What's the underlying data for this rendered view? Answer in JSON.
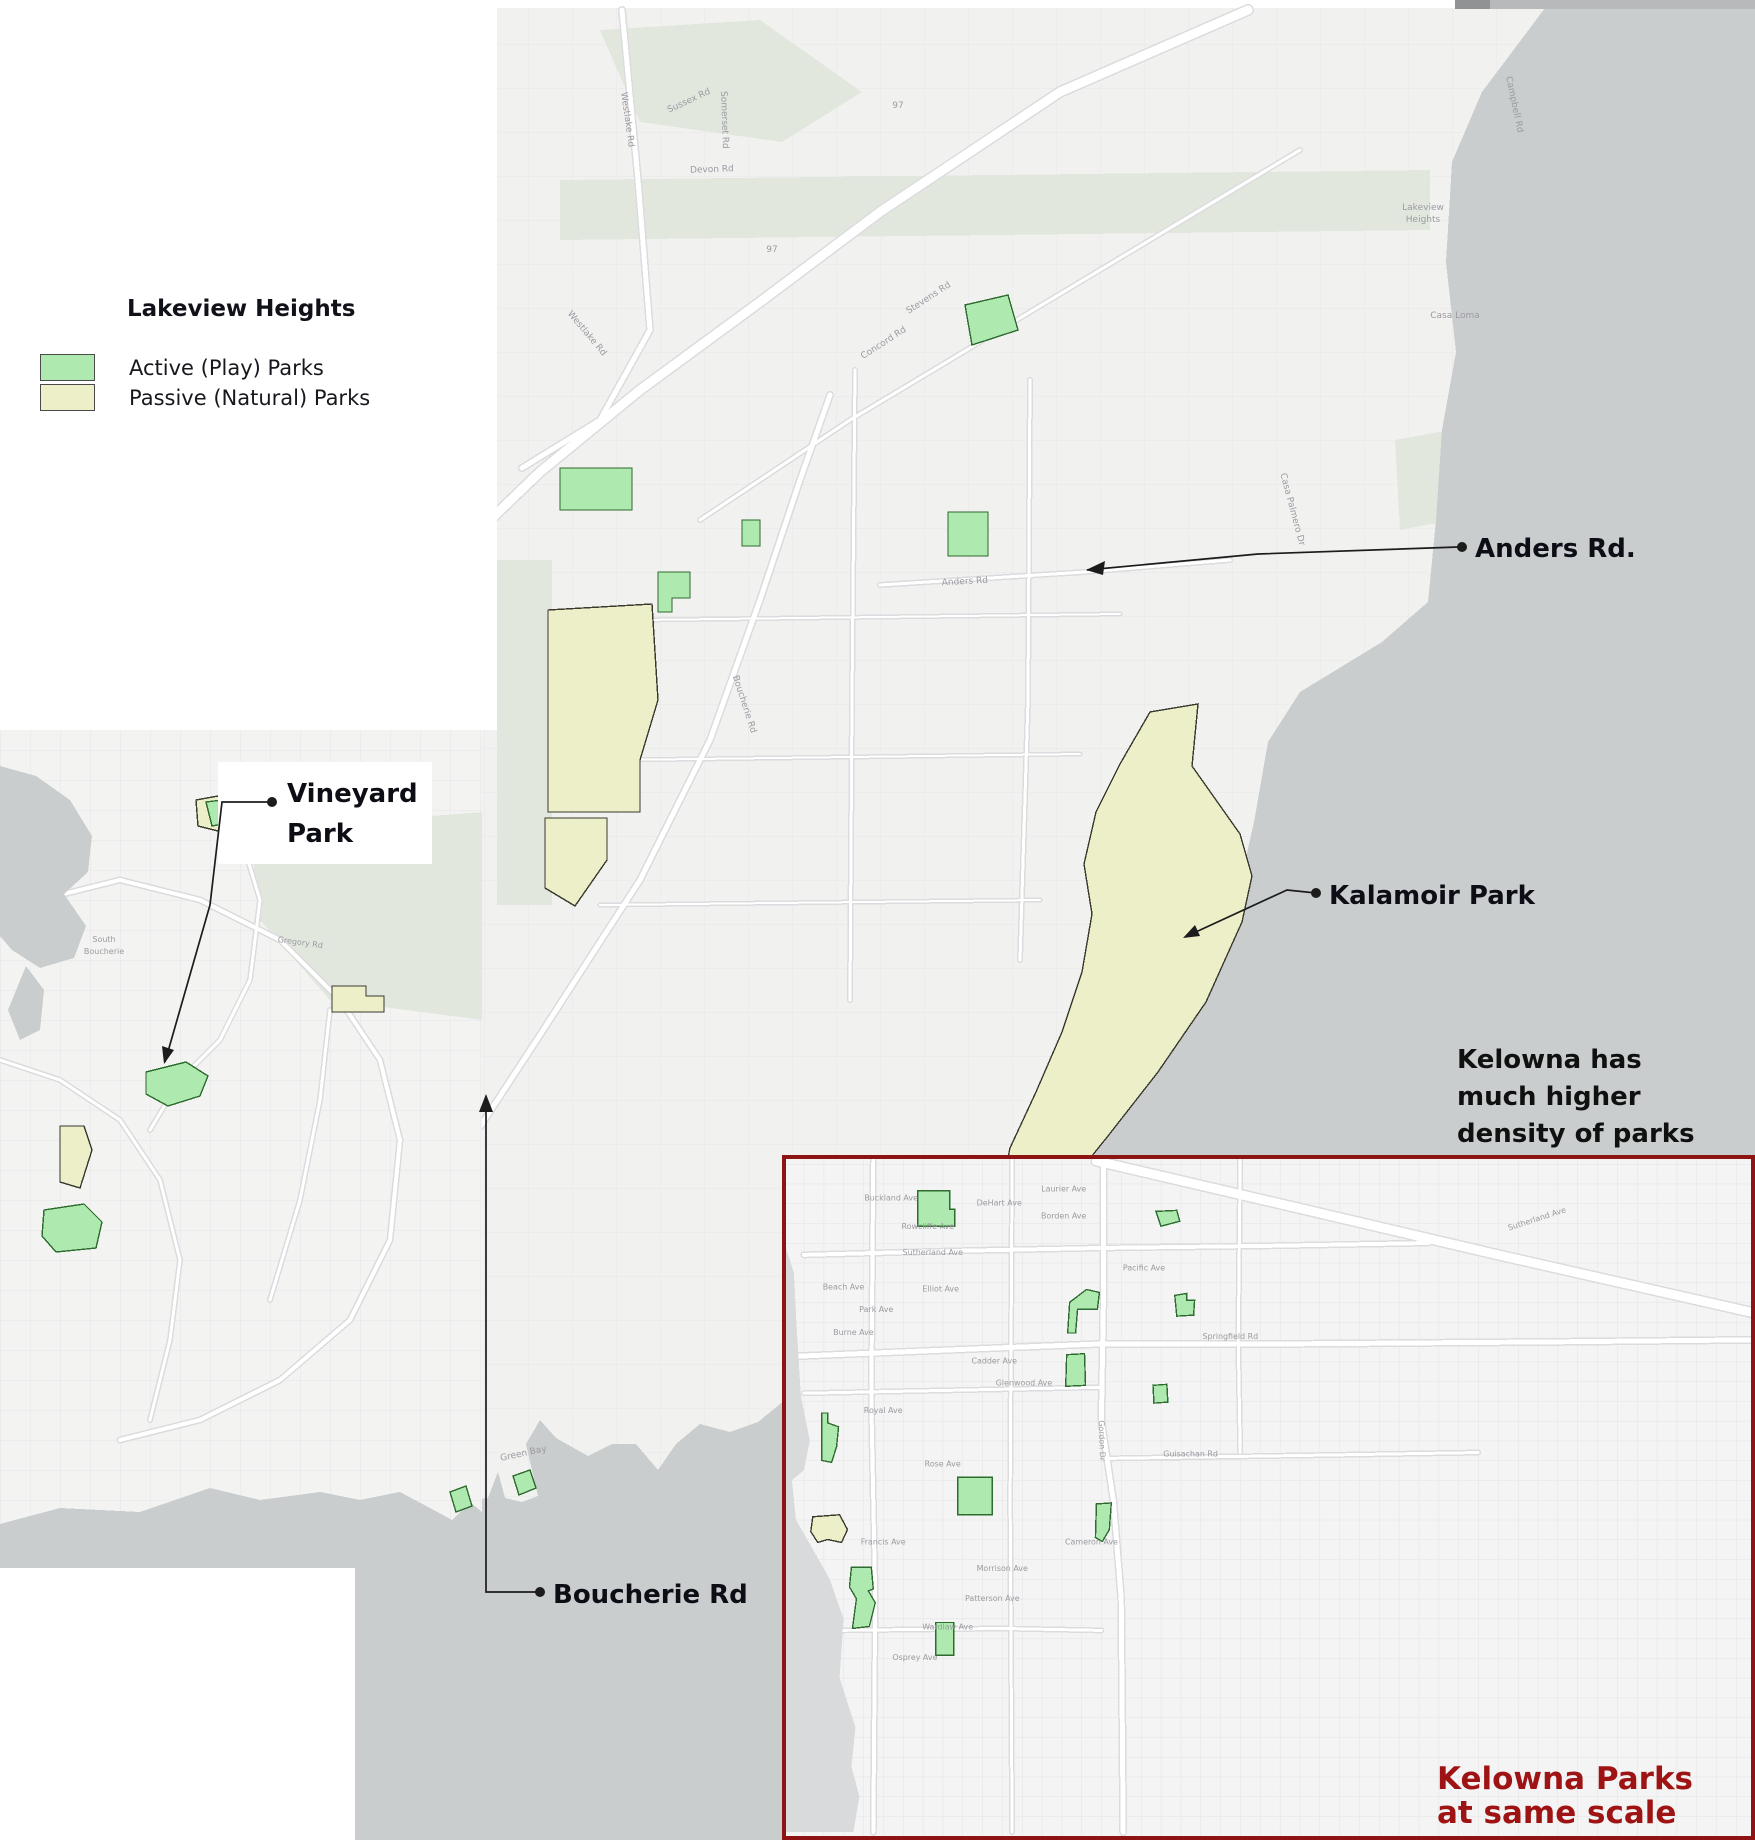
{
  "title": "Lakeview Heights parks map",
  "colors": {
    "active_park": "#aeeab0",
    "passive_park": "#edefc9",
    "active_stroke": "#2e6b2e",
    "passive_stroke": "#3a3a2e",
    "water": "#c9cdce",
    "water_kelowna": "#d8dadb",
    "sage": "#e2e7de",
    "road_casing": "#dcdcdf",
    "map_text": "#9b9ba1",
    "leader": "#1c1c1c",
    "inset_border": "#8e1414",
    "caption_red": "#9e1313",
    "label_black": "#0d0d16"
  },
  "legend": {
    "title": "Lakeview Heights",
    "items": [
      {
        "label": "Active (Play) Parks",
        "type": "active"
      },
      {
        "label": "Passive (Natural) Parks",
        "type": "passive"
      }
    ]
  },
  "annotations": {
    "anders": {
      "text": "Anders Rd."
    },
    "kalamoir": {
      "text": "Kalamoir Park"
    },
    "vineyard": {
      "lines": [
        "Vineyard",
        "Park"
      ]
    },
    "boucherie": {
      "text": "Boucherie Rd"
    },
    "density_note": {
      "lines": [
        "Kelowna has",
        "much higher",
        "density of parks"
      ]
    },
    "kelowna_caption": {
      "lines": [
        "Kelowna Parks",
        "at same scale"
      ]
    }
  },
  "geo": {
    "main": {
      "land": "355,8 1755,8 1755,1840 355,1840",
      "sage": [
        "560,180 1430,170 1430,230 560,240",
        "600,30 760,20 862,92 782,142 640,122",
        "497,560 552,560 552,905 497,905",
        "1395,440 1450,430 1452,520 1400,530"
      ],
      "roads": [
        {
          "p": "1248,10 1060,92 880,212 760,302 640,390 540,472 488,522",
          "w": 9
        },
        {
          "p": "622,10 638,180 650,330 600,420 522,468",
          "w": 5
        },
        {
          "p": "455,1165 540,1035 640,880 710,740 760,600 800,480 830,395",
          "w": 5
        },
        {
          "p": "700,520 850,420 1000,330 1150,240 1300,150",
          "w": 3
        },
        {
          "p": "1560,12 1520,120 1500,220 1490,330 1478,430 1470,540",
          "w": 4
        },
        {
          "p": "855,370 852,700 850,1000",
          "w": 3
        },
        {
          "p": "1030,380 1028,700 1020,960",
          "w": 3
        },
        {
          "p": "640,620 1120,614",
          "w": 2
        },
        {
          "p": "620,760 1080,754",
          "w": 2
        },
        {
          "p": "600,905 1040,900",
          "w": 2
        },
        {
          "p": "880,585 1085,572 1230,560",
          "w": 3
        }
      ],
      "water": [
        "1545,8 1755,8 1755,1840 355,1840 355,1552 372,1540 396,1524 424,1528 450,1520 468,1500 488,1498 498,1472 505,1498 522,1502 538,1496 532,1470 526,1444 540,1420 556,1438 588,1456 612,1444 636,1444 658,1470 676,1444 700,1424 730,1432 758,1422 790,1396 838,1354 900,1308 986,1248 1060,1182 1130,1092 1192,990 1240,884 1254,822 1268,742 1300,692 1382,642 1428,602 1436,520 1442,430 1456,352 1446,262 1452,162 1482,92"
      ],
      "parks": [
        {
          "name": "park-top-green",
          "type": "active",
          "pts": "965,305 1008,295 1018,330 972,345"
        },
        {
          "name": "park-green-rect",
          "type": "active",
          "pts": "560,468 632,468 632,510 560,510"
        },
        {
          "name": "park-tiny-green",
          "type": "active",
          "pts": "742,520 760,520 760,546 742,546"
        },
        {
          "name": "park-anders-green",
          "type": "active",
          "pts": "948,512 988,512 988,556 948,556"
        },
        {
          "name": "park-small-L",
          "type": "active",
          "pts": "658,572 690,572 690,598 672,598 672,612 658,612"
        },
        {
          "name": "park-large-passive",
          "type": "passive",
          "pts": "548,610 652,604 658,700 640,760 640,812 548,812"
        },
        {
          "name": "park-passive-south",
          "type": "passive",
          "pts": "545,818 607,818 607,860 575,906 545,888"
        },
        {
          "name": "kalamoir-park",
          "type": "passive",
          "pts": "1150,712 1198,704 1192,766 1240,834 1252,876 1242,922 1206,1002 1158,1072 1108,1136 1066,1188 1034,1218 1002,1186 1010,1148 1036,1092 1062,1032 1082,972 1092,914 1084,864 1096,812 1120,764"
        },
        {
          "name": "park-greenbay",
          "type": "active",
          "pts": "513,1476 530,1470 536,1488 519,1495"
        }
      ],
      "labels": [
        {
          "t": "Westlake Rd",
          "x": 625,
          "y": 120,
          "r": 82
        },
        {
          "t": "Westlake Rd",
          "x": 585,
          "y": 335,
          "r": 50
        },
        {
          "t": "Stevens Rd",
          "x": 930,
          "y": 300,
          "r": -33
        },
        {
          "t": "Concord Rd",
          "x": 885,
          "y": 345,
          "r": -33
        },
        {
          "t": "Somerset Rd",
          "x": 722,
          "y": 120,
          "r": 88
        },
        {
          "t": "Devon Rd",
          "x": 712,
          "y": 172,
          "r": -2
        },
        {
          "t": "Sussex Rd",
          "x": 690,
          "y": 103,
          "r": -25
        },
        {
          "t": "Boucherie Rd",
          "x": 742,
          "y": 705,
          "r": 72
        },
        {
          "t": "Campbell Rd",
          "x": 1512,
          "y": 105,
          "r": 78
        },
        {
          "t": "Casa Palmero Dr",
          "x": 1290,
          "y": 510,
          "r": 75
        },
        {
          "t": "Anders Rd",
          "x": 965,
          "y": 584,
          "r": -3
        },
        {
          "t": "Lakeview",
          "x": 1423,
          "y": 210,
          "r": 0
        },
        {
          "t": "Heights",
          "x": 1423,
          "y": 222,
          "r": 0
        },
        {
          "t": "Casa Loma",
          "x": 1455,
          "y": 318,
          "r": 0
        },
        {
          "t": "Green Bay",
          "x": 524,
          "y": 1456,
          "r": -12
        },
        {
          "t": "97",
          "x": 898,
          "y": 108,
          "r": 0
        },
        {
          "t": "97",
          "x": 772,
          "y": 252,
          "r": 0
        }
      ]
    },
    "left_inset": {
      "land": "0,728 482,728 482,1568 0,1568",
      "sage": [
        "250,830 482,812 482,1020 330,1000 260,920"
      ],
      "roads": [
        {
          "p": "40,900 120,880 200,900 280,940 340,1000 380,1060 400,1140 390,1240 350,1320 280,1380 200,1420 120,1440",
          "w": 4
        },
        {
          "p": "240,834 260,900 250,980 220,1040 180,1080 150,1130",
          "w": 3
        },
        {
          "p": "0,1060 60,1080 120,1120 160,1180 180,1260 170,1340 150,1420",
          "w": 3
        },
        {
          "p": "330,1010 320,1100 300,1200 270,1300",
          "w": 3
        }
      ],
      "water": [
        "0,766 36,776 70,800 92,836 88,872 64,894 86,926 74,958 40,968 12,950 0,936",
        "26,966 44,990 40,1030 20,1040 8,1010",
        "0,1524 60,1508 140,1512 210,1488 260,1500 320,1492 360,1500 400,1492 430,1508 452,1520 470,1502 482,1512 482,1568 0,1568"
      ],
      "parks": [
        {
          "name": "combo-passive",
          "type": "passive",
          "pts": "196,800 240,792 276,800 272,826 230,834 198,826"
        },
        {
          "name": "combo-active",
          "type": "active",
          "pts": "206,802 238,798 244,820 212,826"
        },
        {
          "name": "small-passive",
          "type": "passive",
          "pts": "332,986 366,986 366,996 384,996 384,1012 332,1012"
        },
        {
          "name": "vineyard-park",
          "type": "active",
          "pts": "146,1072 186,1062 208,1076 200,1096 168,1106 146,1094"
        },
        {
          "name": "sliver-passive",
          "type": "passive",
          "pts": "60,1126 84,1126 92,1150 80,1188 60,1182"
        },
        {
          "name": "shore-active",
          "type": "active",
          "pts": "44,1210 84,1204 102,1222 96,1248 56,1252 42,1236"
        },
        {
          "name": "bay-active",
          "type": "active",
          "pts": "450,1492 466,1486 472,1506 456,1512"
        }
      ],
      "labels": [
        {
          "t": "South",
          "x": 104,
          "y": 942,
          "r": 0
        },
        {
          "t": "Boucherie",
          "x": 104,
          "y": 954,
          "r": 0
        },
        {
          "t": "Gregory Rd",
          "x": 300,
          "y": 945,
          "r": 8
        }
      ]
    },
    "kelowna": {
      "land": "782,1155 1755,1155 1755,1840 782,1840",
      "sage": [],
      "roads": [
        {
          "p": "1095,1157 1300,1205 1500,1252 1755,1310",
          "w": 9
        },
        {
          "p": "782,1355 1000,1346 1102,1342 1300,1342 1560,1340 1755,1338",
          "w": 5
        },
        {
          "p": "800,1252 950,1248 1100,1245 1260,1243 1430,1240",
          "w": 4
        },
        {
          "p": "1102,1155 1102,1300 1100,1420 1112,1500 1120,1600 1122,1836",
          "w": 5
        },
        {
          "p": "870,1155 868,1400 872,1600 870,1836",
          "w": 4
        },
        {
          "p": "1010,1155 1008,1500 1010,1836",
          "w": 3
        },
        {
          "p": "800,1392 1000,1388 1100,1386",
          "w": 3
        },
        {
          "p": "1102,1458 1300,1455 1480,1452",
          "w": 3
        },
        {
          "p": "830,1632 1000,1630 1100,1632",
          "w": 3
        },
        {
          "p": "1240,1155 1238,1340 1240,1452",
          "w": 3
        }
      ],
      "water": [
        "782,1245 790,1270 793,1330 797,1395 806,1440 800,1470 788,1480 792,1520 812,1555 826,1580 840,1620 836,1680 852,1730 848,1770 856,1800 850,1836 782,1836"
      ],
      "parks": [
        {
          "name": "kel-1",
          "type": "active",
          "pts": "915,1187 947,1187 947,1206 952,1206 952,1223 915,1223"
        },
        {
          "name": "kel-2",
          "type": "active",
          "pts": "1155,1208 1176,1207 1179,1218 1160,1223"
        },
        {
          "name": "kel-3",
          "type": "active",
          "pts": "1085,1287 1098,1290 1096,1307 1076,1307 1074,1331 1066,1331 1068,1300"
        },
        {
          "name": "kel-4",
          "type": "active",
          "pts": "1174,1293 1186,1291 1186,1298 1194,1298 1193,1313 1176,1314"
        },
        {
          "name": "kel-5",
          "type": "active",
          "pts": "1065,1353 1083,1352 1084,1384 1064,1385"
        },
        {
          "name": "kel-6",
          "type": "active",
          "pts": "1152,1384 1166,1383 1167,1401 1153,1402"
        },
        {
          "name": "kel-7",
          "type": "active",
          "pts": "818,1412 824,1412 824,1422 835,1426 833,1446 828,1462 818,1460"
        },
        {
          "name": "kel-8",
          "type": "active",
          "pts": "955,1477 990,1477 990,1515 955,1515"
        },
        {
          "name": "kel-9",
          "type": "active",
          "pts": "1095,1504 1110,1503 1108,1530 1101,1542 1094,1538"
        },
        {
          "name": "kel-10",
          "type": "active",
          "pts": "848,1568 868,1568 870,1590 865,1592 872,1604 866,1628 849,1630 853,1600 846,1588"
        },
        {
          "name": "kel-11",
          "type": "active",
          "pts": "933,1624 951,1624 951,1657 933,1657"
        },
        {
          "name": "kel-12",
          "type": "passive",
          "pts": "809,1517 836,1515 844,1530 838,1543 824,1540 814,1543 807,1532"
        }
      ],
      "labels": [
        {
          "t": "Buckland Ave",
          "x": 888,
          "y": 1197,
          "r": 0
        },
        {
          "t": "Laurier Ave",
          "x": 1062,
          "y": 1188,
          "r": 0
        },
        {
          "t": "DeHart Ave",
          "x": 997,
          "y": 1202,
          "r": 0
        },
        {
          "t": "Borden Ave",
          "x": 1062,
          "y": 1215,
          "r": 0
        },
        {
          "t": "Rowcliffe Ave",
          "x": 925,
          "y": 1226,
          "r": 0
        },
        {
          "t": "Sutherland Ave",
          "x": 930,
          "y": 1252,
          "r": 0
        },
        {
          "t": "Sutherland Ave",
          "x": 1540,
          "y": 1218,
          "r": -18
        },
        {
          "t": "Pacific Ave",
          "x": 1143,
          "y": 1268,
          "r": 0
        },
        {
          "t": "Elliot Ave",
          "x": 938,
          "y": 1289,
          "r": 0
        },
        {
          "t": "Beach Ave",
          "x": 840,
          "y": 1287,
          "r": 0
        },
        {
          "t": "Park Ave",
          "x": 873,
          "y": 1310,
          "r": 0
        },
        {
          "t": "Burne Ave",
          "x": 850,
          "y": 1333,
          "r": 0
        },
        {
          "t": "Springfield Rd",
          "x": 1230,
          "y": 1337,
          "r": 0
        },
        {
          "t": "Cadder Ave",
          "x": 992,
          "y": 1362,
          "r": 0
        },
        {
          "t": "Glenwood Ave",
          "x": 1022,
          "y": 1384,
          "r": 0
        },
        {
          "t": "Royal Ave",
          "x": 880,
          "y": 1412,
          "r": 0
        },
        {
          "t": "Gordon Dr",
          "x": 1098,
          "y": 1440,
          "r": 88
        },
        {
          "t": "Guisachan Rd",
          "x": 1190,
          "y": 1456,
          "r": 0
        },
        {
          "t": "Rose Ave",
          "x": 940,
          "y": 1466,
          "r": 0
        },
        {
          "t": "Cameron Ave",
          "x": 1090,
          "y": 1545,
          "r": 0
        },
        {
          "t": "Francis Ave",
          "x": 880,
          "y": 1545,
          "r": 0
        },
        {
          "t": "Morrison Ave",
          "x": 1000,
          "y": 1572,
          "r": 0
        },
        {
          "t": "Patterson Ave",
          "x": 990,
          "y": 1602,
          "r": 0
        },
        {
          "t": "Wardlaw Ave",
          "x": 945,
          "y": 1631,
          "r": 0
        },
        {
          "t": "Osprey Ave",
          "x": 912,
          "y": 1662,
          "r": 0
        }
      ]
    },
    "overlay": {
      "lines": [
        "1087,570 1258,554 1458,547",
        "1316,893 1287,890 1185,937",
        "272,802 222,802 210,905 165,1062",
        "540,1592 486,1592 486,1098"
      ],
      "arrows": [
        "1086,570 1105,561 1103,575",
        "1183,938 1195,925 1200,936",
        "164,1064 162,1046 174,1050",
        "486,1094 479,1112 493,1112"
      ],
      "bullets": [
        [
          1462,
          547
        ],
        [
          1316,
          893
        ],
        [
          272,
          802
        ],
        [
          540,
          1592
        ]
      ]
    }
  }
}
